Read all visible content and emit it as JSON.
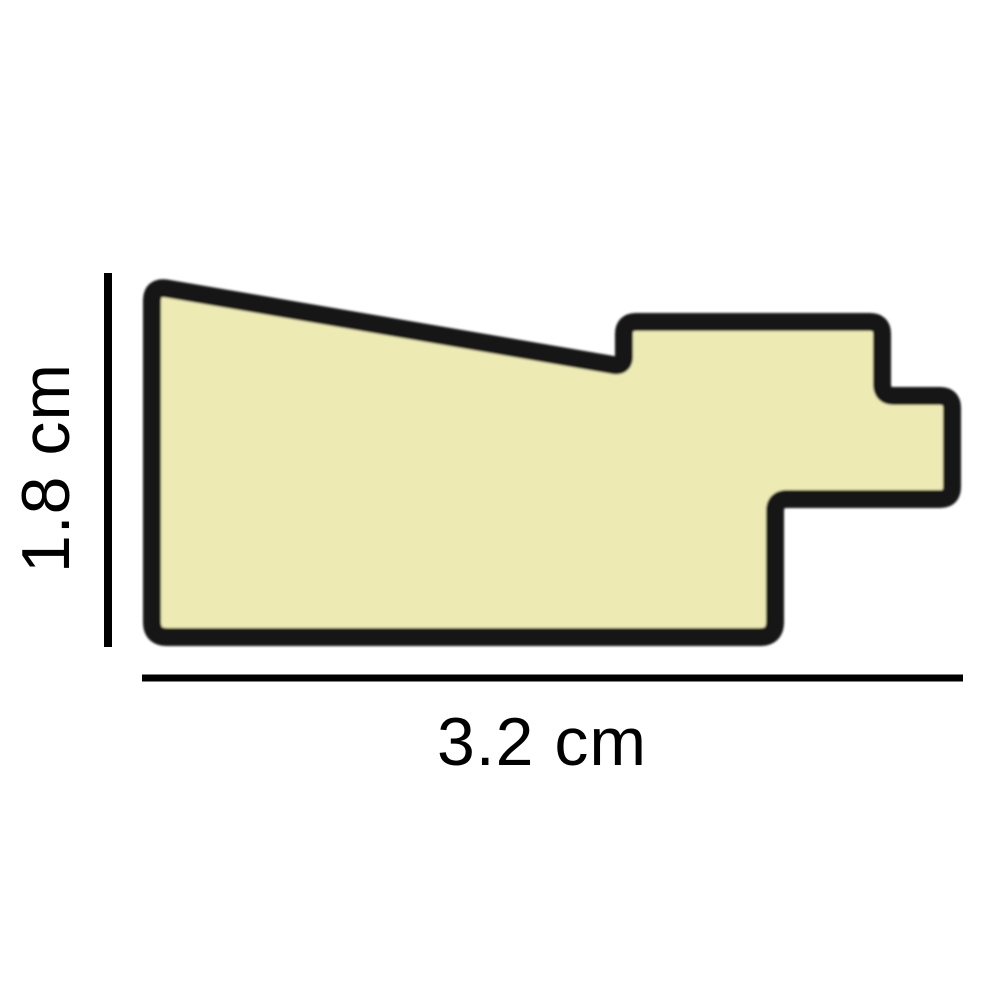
{
  "figure": {
    "type": "moulding-profile-cross-section",
    "description": "Picture frame moulding profile cross-section with dimension lines",
    "dimensions": {
      "height_label": "1.8 cm",
      "width_label": "3.2 cm"
    }
  },
  "colors": {
    "shape_fill": "#EDEAB4",
    "shape_outline": "#161616",
    "dimension_line": "#000000",
    "background": "#ffffff"
  }
}
